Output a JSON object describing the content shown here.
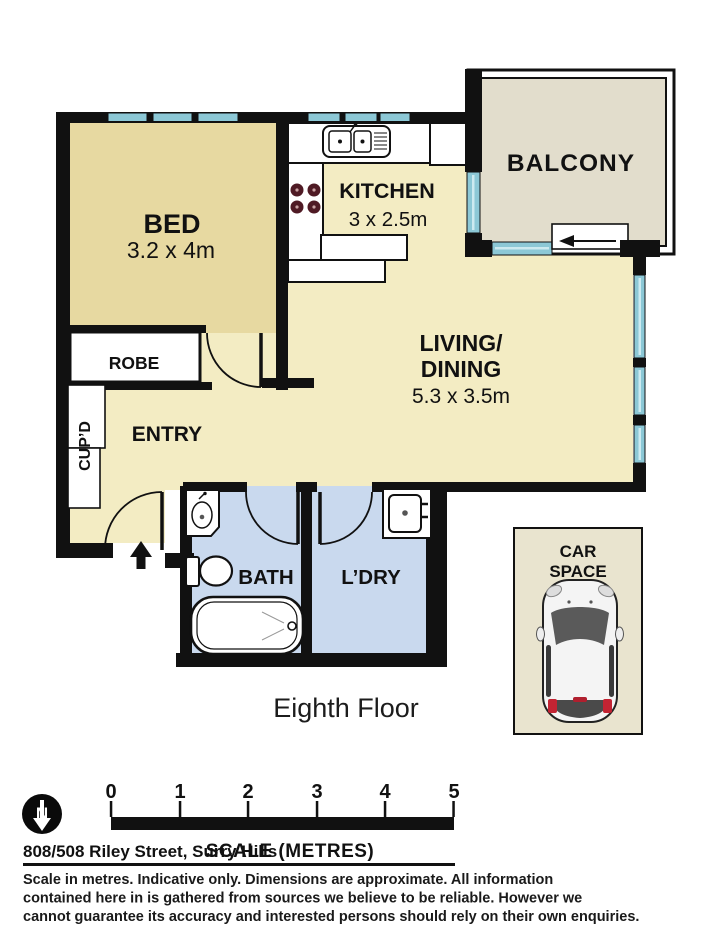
{
  "floorplan": {
    "rooms": {
      "bed": {
        "label": "BED",
        "dims": "3.2 x 4m"
      },
      "kitchen": {
        "label": "KITCHEN",
        "dims": "3 x 2.5m"
      },
      "balcony": {
        "label": "BALCONY"
      },
      "living": {
        "label_line1": "LIVING/",
        "label_line2": "DINING",
        "dims": "5.3 x 3.5m"
      },
      "robe": {
        "label": "ROBE"
      },
      "cupboard": {
        "label": "CUP’D"
      },
      "entry": {
        "label": "ENTRY"
      },
      "bath": {
        "label": "BATH"
      },
      "laundry": {
        "label": "L’DRY"
      },
      "car_space": {
        "label_line1": "CAR",
        "label_line2": "SPACE"
      }
    },
    "floor_label": "Eighth Floor"
  },
  "scale_bar": {
    "ticks": [
      "0",
      "1",
      "2",
      "3",
      "4",
      "5"
    ],
    "label": "SCALE (METRES)",
    "north_label": "N"
  },
  "address": "808/508 Riley Street, Surry Hills",
  "disclaimer": {
    "line1": "Scale in metres. Indicative only. Dimensions are approximate. All information",
    "line2": "contained here in is gathered from sources we believe to be reliable. However we",
    "line3": "cannot guarantee its accuracy and interested persons should rely on their own enquiries."
  },
  "colors": {
    "cream": "#f3ecc3",
    "bed_tan": "#e7d9a1",
    "balcony": "#e2ddcc",
    "wet_blue": "#c9d9ee",
    "window_teal": "#8cc8d6",
    "car_space_bg": "#e9e4cf",
    "wall": "#111111"
  }
}
